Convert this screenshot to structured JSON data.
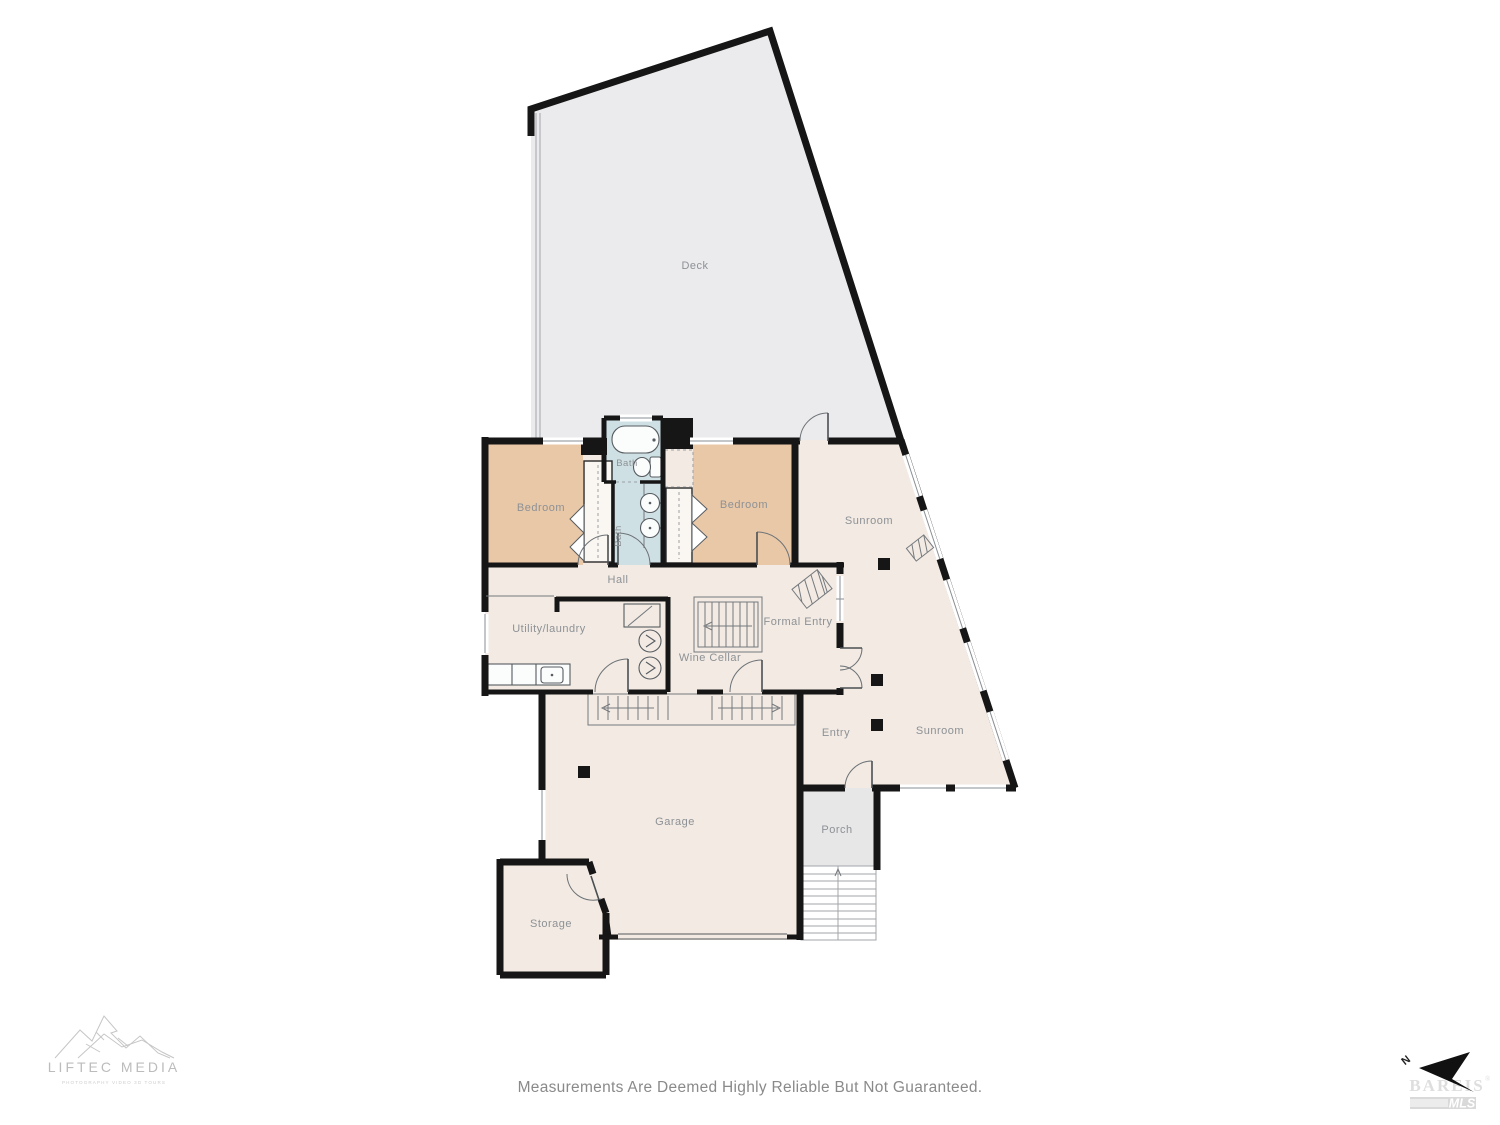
{
  "page": {
    "disclaimer": "Measurements Are Deemed Highly Reliable But Not Guaranteed."
  },
  "colors": {
    "wall": "#161616",
    "deck": "#ebebed",
    "floor": "#f2eae3",
    "bedroom": "#e9c8a8",
    "bath": "#cfe0e4",
    "porch": "#e7e7e8",
    "label": "#8d9195"
  },
  "rooms": {
    "deck": "Deck",
    "bath_upper": "Bath",
    "bath_lower": "Bath",
    "bedroom_left": "Bedroom",
    "bedroom_right": "Bedroom",
    "sunroom_upper": "Sunroom",
    "sunroom_lower": "Sunroom",
    "hall": "Hall",
    "utility": "Utility/laundry",
    "formal_entry": "Formal Entry",
    "wine_cellar": "Wine Cellar",
    "entry": "Entry",
    "garage": "Garage",
    "porch": "Porch",
    "storage": "Storage"
  },
  "branding": {
    "logo_title": "LIFTEC MEDIA",
    "logo_subtitle": "PHOTOGRAPHY   VIDEO   3D TOURS",
    "north_label": "N",
    "mls_name": "BAREIS",
    "mls_registered": "®",
    "mls_suffix": "MLS"
  }
}
